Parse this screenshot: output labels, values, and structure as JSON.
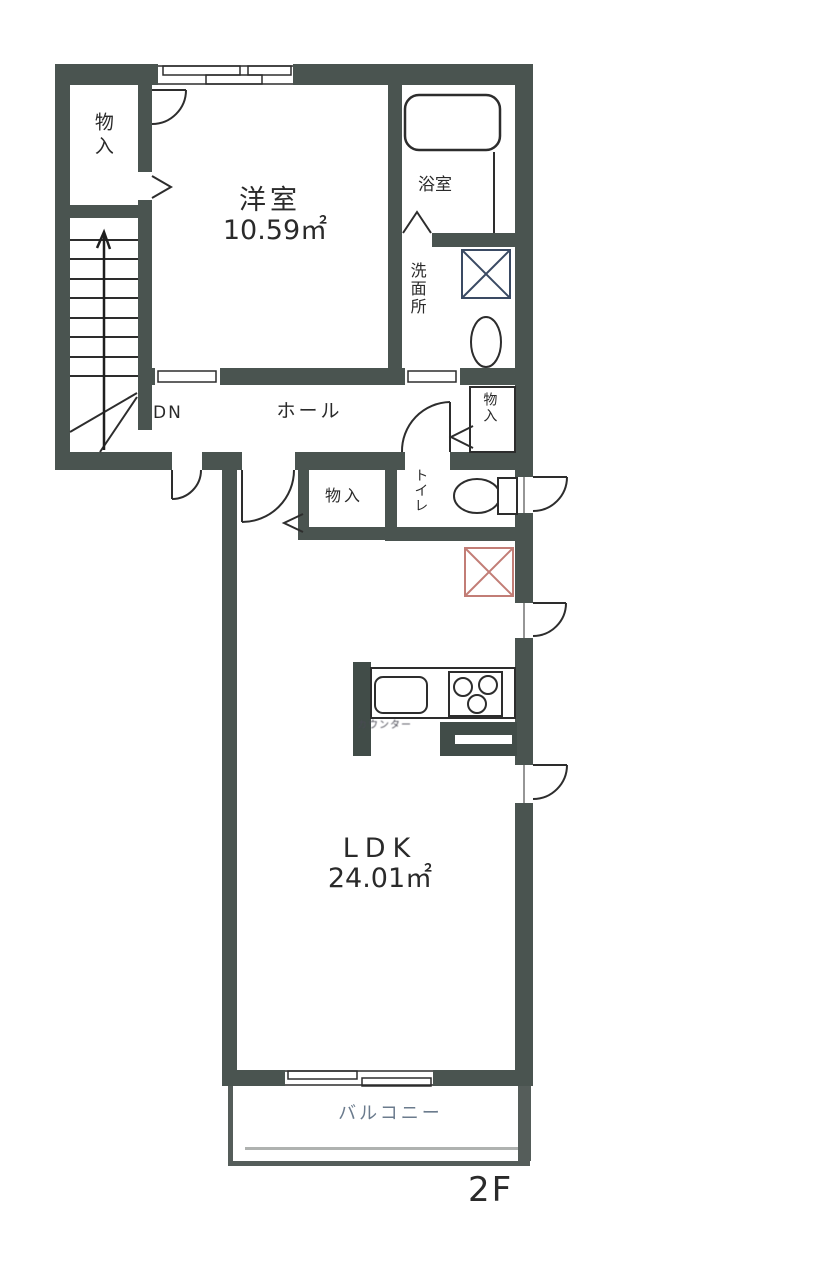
{
  "plan": {
    "floor": "2F",
    "labels": {
      "storage_upper_left": "物入",
      "western_room": "洋室",
      "western_room_area": "10.59㎡",
      "bath": "浴室",
      "washroom": "洗面所",
      "down": "DN",
      "hall": "ホール",
      "storage_hall": "物入",
      "storage_center": "物入",
      "toilet": "トイレ",
      "counter": "カウンター",
      "ldk": "LDK",
      "ldk_area": "24.01㎡",
      "balcony": "バルコニー"
    },
    "colors": {
      "wall": "#4a5450",
      "line": "#2d2d2d",
      "red_x_box": "#c27d76",
      "blue_x_box": "#3a4a63",
      "balcony_text": "#6b7b8d"
    }
  }
}
